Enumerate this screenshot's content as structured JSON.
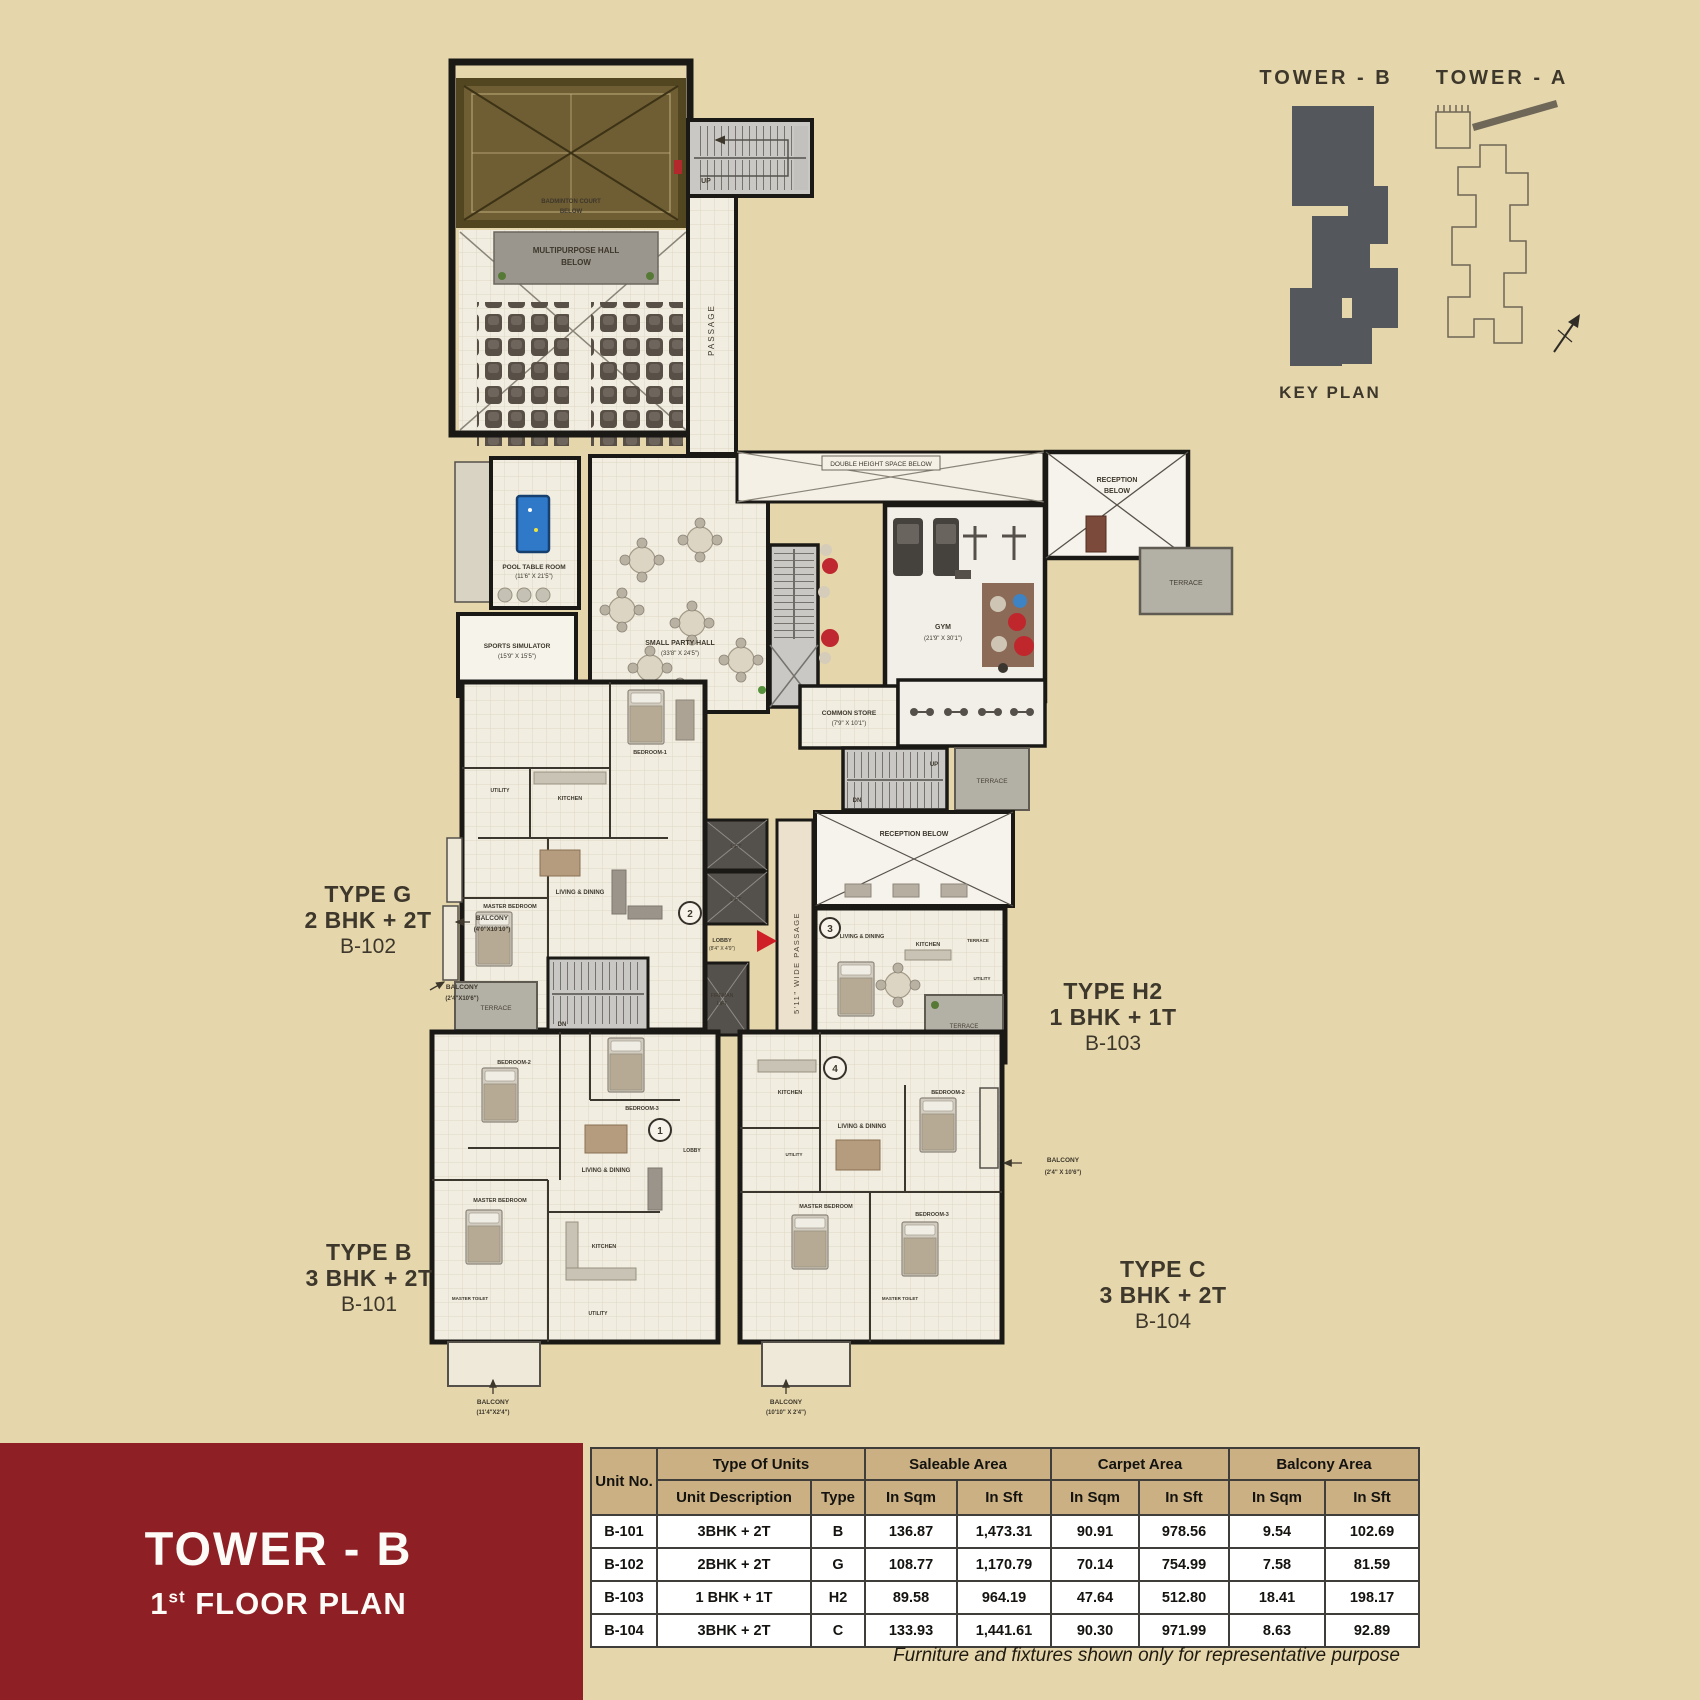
{
  "page": {
    "background": "#e5d7ab",
    "footnote": "Furniture and fixtures shown only for representative purpose"
  },
  "key_plan": {
    "tower_b": "TOWER - B",
    "tower_a": "TOWER - A",
    "title": "KEY PLAN",
    "tower_b_fill": "#54575c"
  },
  "banner": {
    "title": "TOWER - B",
    "floor_num": "1",
    "floor_sup": "st",
    "floor_rest": " FLOOR PLAN",
    "color": "#8e2025"
  },
  "unit_callouts": [
    {
      "type": "TYPE G",
      "config": "2 BHK + 2T",
      "unit": "B-102"
    },
    {
      "type": "TYPE H2",
      "config": "1 BHK + 1T",
      "unit": "B-103"
    },
    {
      "type": "TYPE B",
      "config": "3 BHK + 2T",
      "unit": "B-101"
    },
    {
      "type": "TYPE C",
      "config": "3 BHK + 2T",
      "unit": "B-104"
    }
  ],
  "plan": {
    "badminton_l1": "BADMINTON COURT",
    "badminton_l2": "BELOW",
    "hall_l1": "MULTIPURPOSE HALL",
    "hall_l2": "BELOW",
    "passage_v": "PASSAGE",
    "up": "UP",
    "dn": "DN",
    "pool_l1": "POOL TABLE ROOM",
    "pool_l2": "(11'6\" X 21'5\")",
    "sim_l1": "SPORTS SIMULATOR",
    "sim_l2": "(15'9\" X 15'5\")",
    "party_l1": "SMALL PARTY HALL",
    "party_l2": "(33'8\" X 24'5\")",
    "gym_l1": "GYM",
    "gym_l2": "(21'9\" X 30'1\")",
    "dh": "DOUBLE HEIGHT SPACE BELOW",
    "reception_l1": "RECEPTION",
    "reception_l2": "BELOW",
    "reception_mid": "RECEPTION BELOW",
    "store_l1": "COMMON STORE",
    "store_l2": "(7'9\" X 10'1\")",
    "terrace": "TERRACE",
    "wide_passage": "5'11\" WIDE PASSAGE",
    "lift": "LIFT",
    "fireman_l1": "FIREMAN",
    "fireman_l2": "LIFT",
    "lobby": "LOBBY",
    "lobby_dims": "(8'4\" X 4'9\")",
    "rooms": {
      "living_dining": "LIVING & DINING",
      "master_bedroom": "MASTER BEDROOM",
      "master_toilet": "MASTER TOILET",
      "bedroom1": "BEDROOM-1",
      "bedroom2": "BEDROOM-2",
      "bedroom3": "BEDROOM-3",
      "bedroom": "BEDROOM",
      "kitchen": "KITCHEN",
      "utility": "UTILITY"
    },
    "balconies": {
      "label": "BALCONY",
      "b1": "(4'0\"X10'10\")",
      "b2": "(2'4\"X10'6\")",
      "b3": "(2'4\" X 10'6\")",
      "b4": "(11'4\"X2'4\")",
      "b5": "(10'10\" X 2'4\")"
    },
    "unit_marks": [
      "1",
      "2",
      "3",
      "4"
    ]
  },
  "table": {
    "h1": {
      "unit_no": "Unit No.",
      "type_of_units": "Type Of Units",
      "saleable": "Saleable Area",
      "carpet": "Carpet Area",
      "balcony": "Balcony Area"
    },
    "h2": {
      "desc": "Unit Description",
      "type": "Type",
      "sqm": "In Sqm",
      "sft": "In Sft"
    },
    "rows": [
      {
        "unit": "B-101",
        "desc": "3BHK + 2T",
        "type": "B",
        "s_sqm": "136.87",
        "s_sft": "1,473.31",
        "c_sqm": "90.91",
        "c_sft": "978.56",
        "b_sqm": "9.54",
        "b_sft": "102.69"
      },
      {
        "unit": "B-102",
        "desc": "2BHK + 2T",
        "type": "G",
        "s_sqm": "108.77",
        "s_sft": "1,170.79",
        "c_sqm": "70.14",
        "c_sft": "754.99",
        "b_sqm": "7.58",
        "b_sft": "81.59"
      },
      {
        "unit": "B-103",
        "desc": "1 BHK + 1T",
        "type": "H2",
        "s_sqm": "89.58",
        "s_sft": "964.19",
        "c_sqm": "47.64",
        "c_sft": "512.80",
        "b_sqm": "18.41",
        "b_sft": "198.17"
      },
      {
        "unit": "B-104",
        "desc": "3BHK + 2T",
        "type": "C",
        "s_sqm": "133.93",
        "s_sft": "1,441.61",
        "c_sqm": "90.30",
        "c_sft": "971.99",
        "b_sqm": "8.63",
        "b_sft": "92.89"
      }
    ]
  }
}
